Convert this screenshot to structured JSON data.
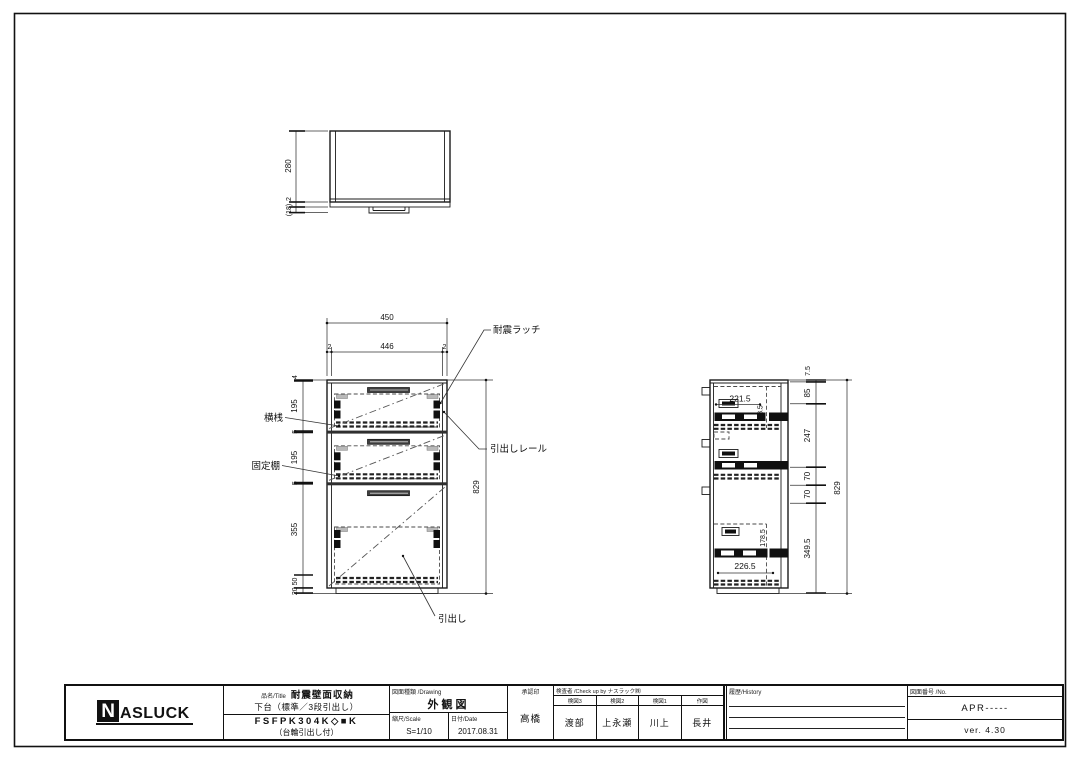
{
  "top_view": {
    "dim_depth": "280",
    "dim_edge": "2",
    "dim_handle": "(18)"
  },
  "front_view": {
    "dim_width": "450",
    "dim_side_l": "2",
    "dim_inner": "446",
    "dim_side_r": "2",
    "dim_top": "4",
    "dim_d1": "195",
    "dim_s1": "5",
    "dim_d2": "195",
    "dim_s2": "5",
    "dim_lower": "355",
    "dim_rail": "50",
    "dim_base": "20",
    "dim_height": "829",
    "callout_latch": "耐震ラッチ",
    "callout_rail": "引出しレール",
    "callout_drawer": "引出し",
    "callout_crossrail": "横桟",
    "callout_shelf": "固定棚"
  },
  "side_view": {
    "dim_top": "7.5",
    "dim_a": "85",
    "dim_b": "247",
    "dim_c": "70",
    "dim_d": "70",
    "dim_e": "349.5",
    "dim_height": "829",
    "dim_box1_w": "221.5",
    "dim_box1_h": "98.5",
    "dim_box3_w": "226.5",
    "dim_box3_h": "178.5"
  },
  "title_block": {
    "logo_n": "N",
    "logo_rest": "ASLUCK",
    "product_label": "品名/Title",
    "product_name": "耐震壁面収納",
    "product_sub": "下台（標準／3段引出し）",
    "product_code": "FSFPK304K◇■K",
    "product_note": "（台輪引出し付）",
    "drawing_label": "図面種類 /Drawing",
    "drawing_value": "外観図",
    "scale_label": "縮尺/Scale",
    "scale_value": "S=1/10",
    "date_label": "日付/Date",
    "date_value": "2017.08.31",
    "approval_label": "承認印",
    "approval_value": "高橋",
    "check_label": "検査者 /Check up by ナスラック㈱",
    "check_cols": [
      {
        "label": "検図3",
        "value": "渡部"
      },
      {
        "label": "検図2",
        "value": "上永瀬"
      },
      {
        "label": "検図1",
        "value": "川上"
      },
      {
        "label": "作図",
        "value": "長井"
      }
    ],
    "history_label": "履歴/History",
    "number_label": "図面番号 /No.",
    "number_value": "APR-----",
    "version": "ver. 4.30"
  }
}
